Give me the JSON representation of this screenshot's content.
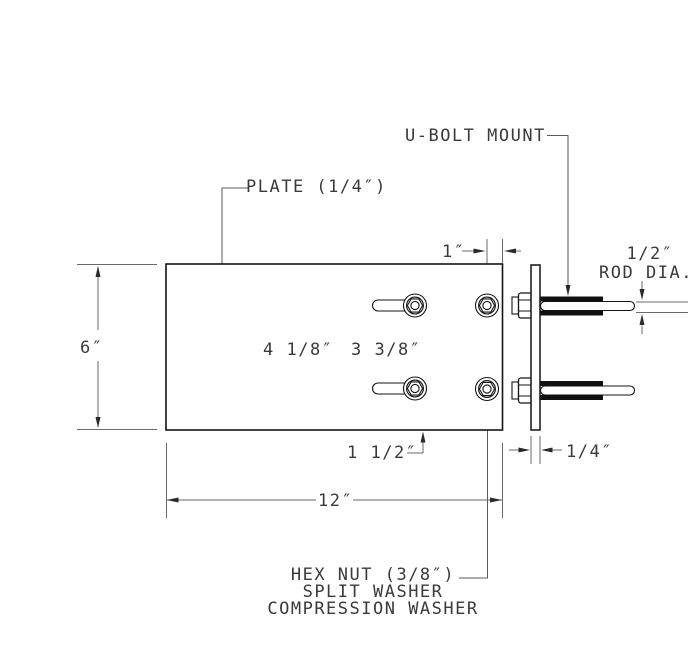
{
  "drawing": {
    "type": "technical-drawing",
    "labels": {
      "u_bolt_mount": "U-BOLT MOUNT",
      "plate": "PLATE (1/4″)",
      "rod_dia_line1": "1/2″",
      "rod_dia_line2": "ROD DIA.",
      "hardware_line1": "HEX NUT (3/8″)",
      "hardware_line2": "SPLIT WASHER",
      "hardware_line3": "COMPRESSION WASHER"
    },
    "dimensions": {
      "plate_height": "6″",
      "plate_width": "12″",
      "bolt_edge_offset": "1″",
      "hole_spacing_outer": "4 1/8″",
      "hole_spacing_inner": "3 3/8″",
      "bottom_bolt_offset": "1 1/2″",
      "mount_plate_thickness": "1/4″"
    },
    "colors": {
      "background": "#ffffff",
      "object_line": "#141414",
      "dimension_line": "#6a6a6a",
      "text": "#3a3a3a",
      "thread_fill": "#101010"
    }
  }
}
